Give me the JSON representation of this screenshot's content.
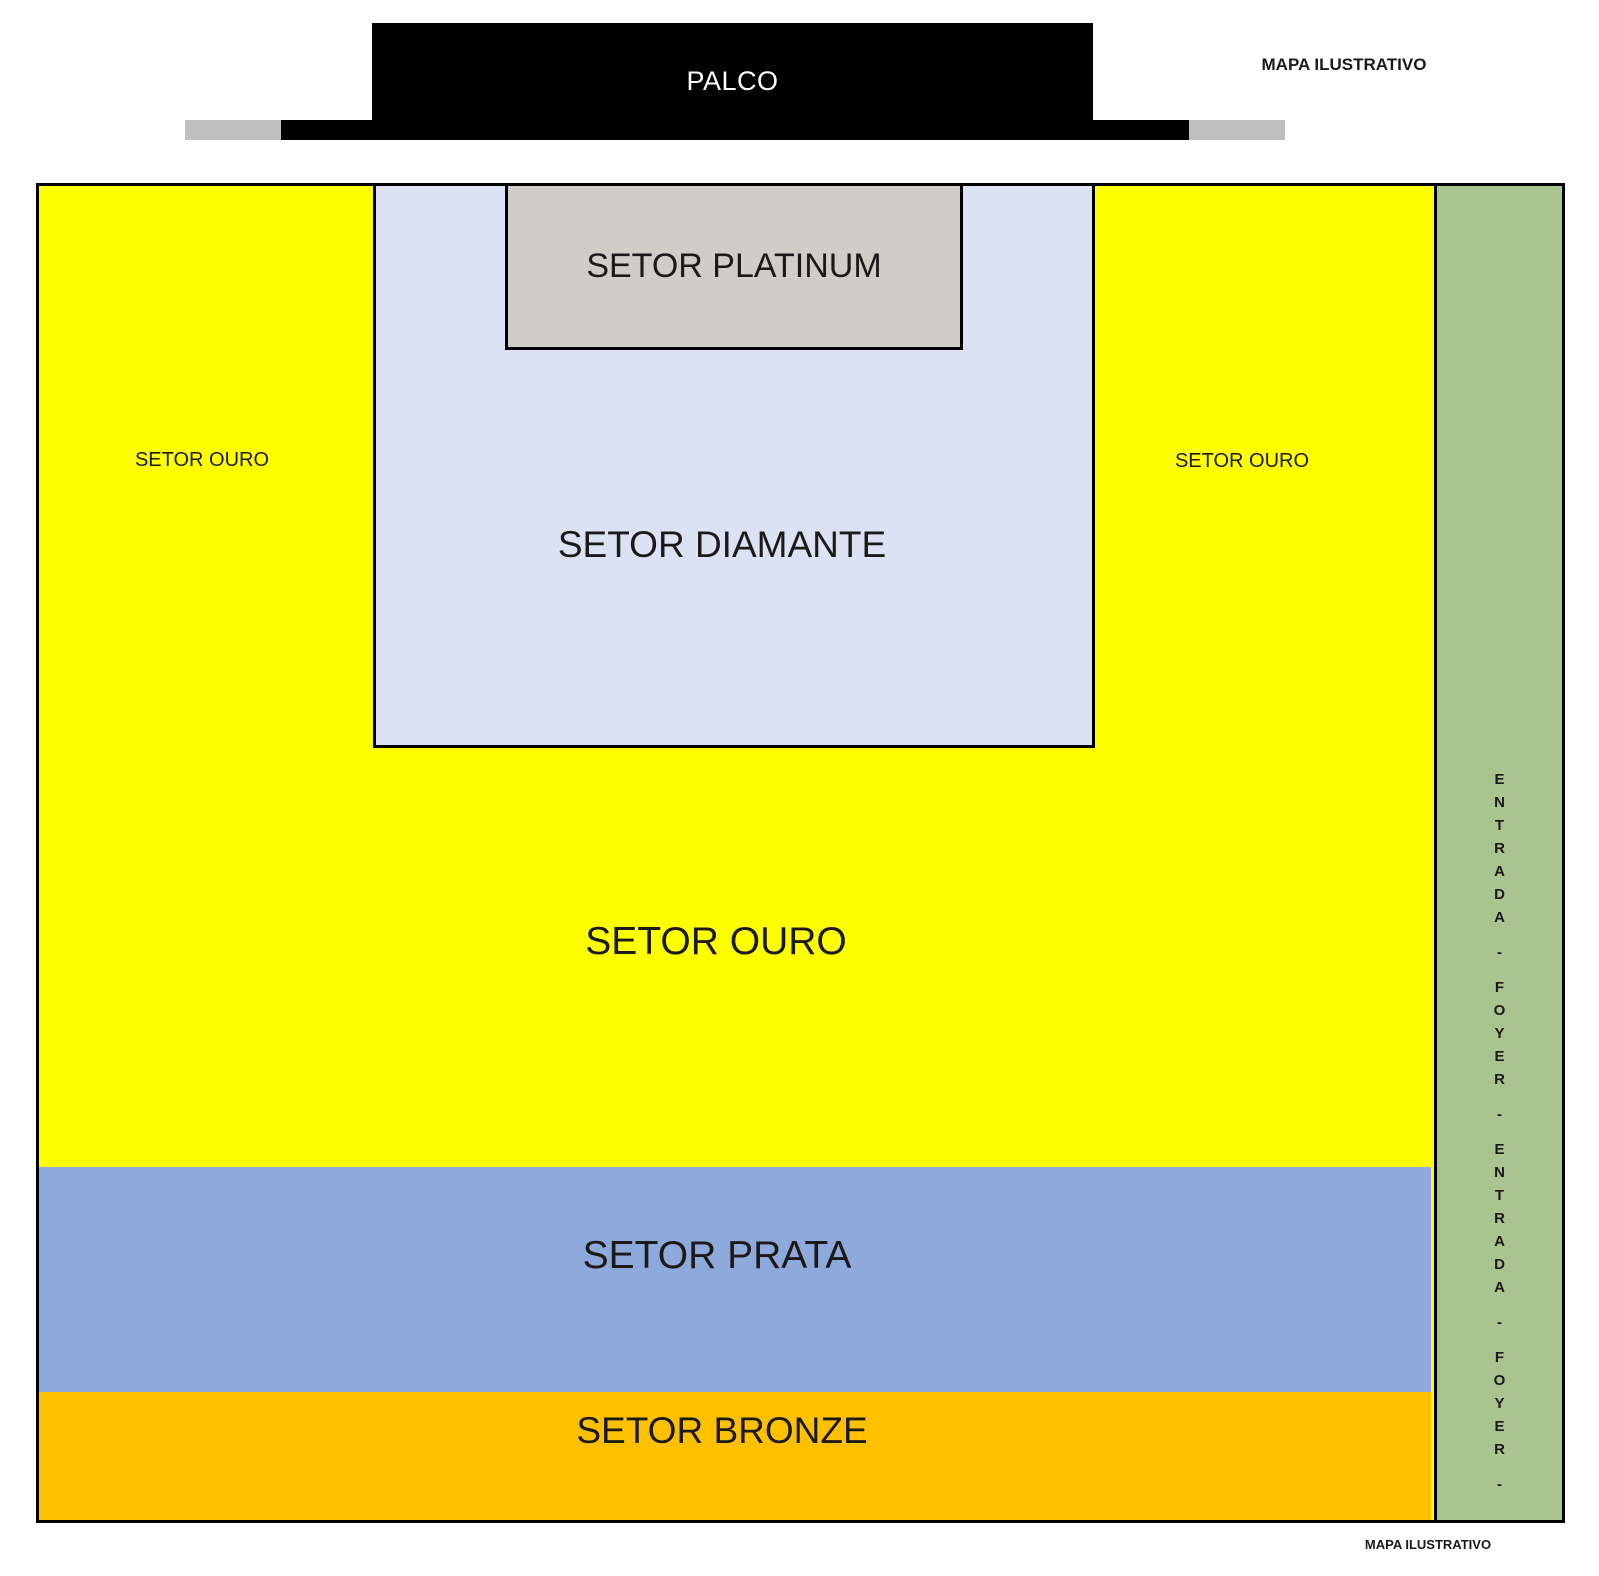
{
  "stage": {
    "label": "PALCO",
    "color": "#000000",
    "wing_color": "#BFBFBF"
  },
  "watermarks": {
    "top": "MAPA ILUSTRATIVO",
    "bottom": "MAPA ILUSTRATIVO"
  },
  "sectors": {
    "platinum": {
      "label": "SETOR PLATINUM",
      "color": "#D0CDC9"
    },
    "diamante": {
      "label": "SETOR DIAMANTE",
      "color": "#DAE2F3"
    },
    "ouro": {
      "label": "SETOR OURO",
      "side_label_left": "SETOR OURO",
      "side_label_right": "SETOR OURO",
      "color": "#FFFF00"
    },
    "prata": {
      "label": "SETOR PRATA",
      "color": "#8EA9DB"
    },
    "bronze": {
      "label": "SETOR BRONZE",
      "color": "#FFC000"
    }
  },
  "entrance": {
    "color": "#A9C48E",
    "vertical_text": "ENTRADA - FOYER - ENTRADA - FOYER -",
    "letters": [
      "E",
      "N",
      "T",
      "R",
      "A",
      "D",
      "A",
      "-",
      "F",
      "O",
      "Y",
      "E",
      "R",
      "-",
      "E",
      "N",
      "T",
      "R",
      "A",
      "D",
      "A",
      "-",
      "F",
      "O",
      "Y",
      "E",
      "R",
      "-"
    ]
  }
}
